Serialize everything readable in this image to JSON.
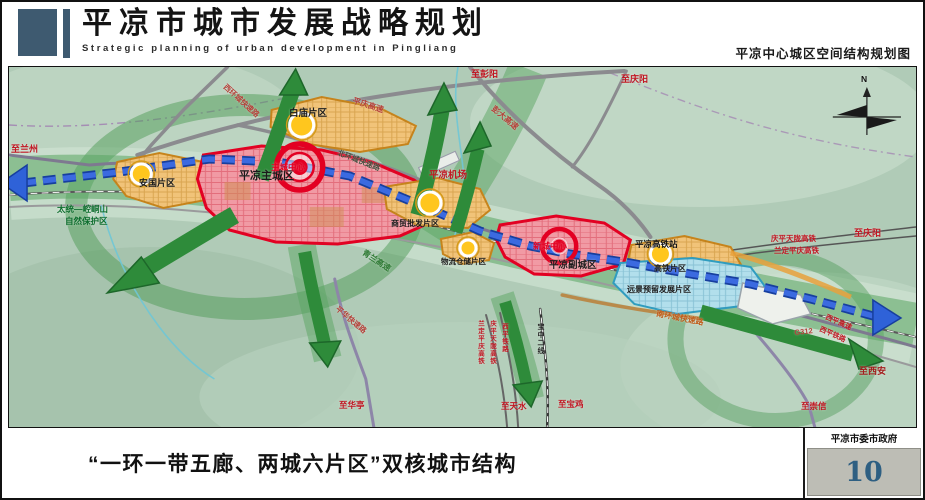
{
  "header": {
    "title": "平凉市城市发展战略规划",
    "subtitle": "Strategic planning of urban development in Pingliang",
    "map_caption": "平凉中心城区空间结构规划图"
  },
  "footer": {
    "caption": "“一环一带五廊、两城六片区”双核城市结构",
    "agency": "平凉市委市政府",
    "page_number": "10"
  },
  "colors": {
    "header_accent": "#3e5a70",
    "core_red": "#e30022",
    "district_orange": "#d18a1f",
    "axis_blue": "#2a59cf",
    "corridor_green": "#2e8b3a",
    "reserve_blue": "#2f9dc0",
    "page_box_bg": "#bdbdb5",
    "page_number_blue": "#2e5f82"
  },
  "map": {
    "compass_n": "N",
    "labels": {
      "zhi_lanzhou": "至兰州",
      "zhi_pengyang": "至彭阳",
      "zhi_qingyang_north": "至庆阳",
      "zhi_qingyang_east": "至庆阳",
      "zhi_xian": "至西安",
      "zhi_chongxin": "至崇信",
      "zhi_huating": "至华亭",
      "zhi_tianshui": "至天水",
      "zhi_baoji": "至宝鸡",
      "xihuan_road": "西环城快速路",
      "beihuan_road": "北环城快速路",
      "nanhuan_road": "南环城快速路",
      "pingqing_expwy": "平庆高速",
      "pengda_expwy": "彭大高速",
      "qinglan_expwy": "青兰高速",
      "pinghua_road": "平华快速路",
      "g312": "G312",
      "xiping_expwy": "西平高速",
      "xiping_railway": "西平铁路",
      "qingping_hsr": "庆平天陇高铁",
      "landing_hsr": "兰定平庆高铁",
      "v_landing_hsr": "兰定平庆高铁",
      "v_qingping_hsr": "庆平天陇高铁",
      "v_xiping_railway": "西平铁路",
      "v_baozhong_line": "宝中二线",
      "airport": "平凉机场",
      "hsr_station": "平凉高铁站",
      "anguo_district": "安国片区",
      "baimiao_district": "白庙片区",
      "main_city": "平凉主城区",
      "main_city_center": "主城中心",
      "shangmao_district": "商贸批发片区",
      "wuliu_district": "物流仓储片区",
      "new_city_center": "新城中心",
      "sub_city": "平凉副城区",
      "gaotie_district": "高铁片区",
      "reserved_district": "远景预留发展片区",
      "nature_reserve_1": "太统—崆峒山",
      "nature_reserve_2": "自然保护区"
    }
  }
}
